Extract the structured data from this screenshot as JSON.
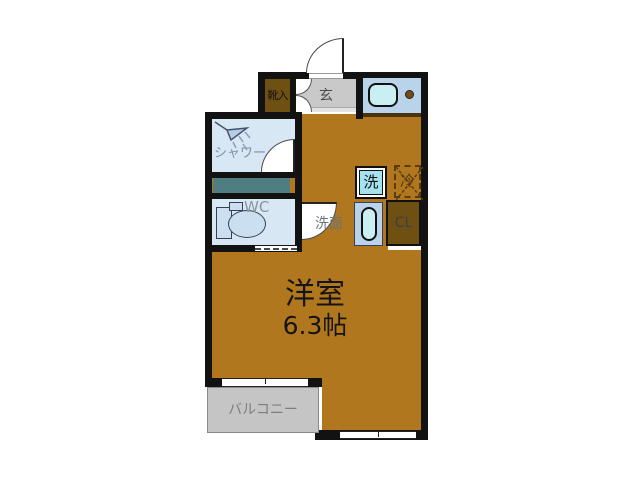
{
  "title": "apartment-floorplan",
  "rooms": {
    "main": {
      "label": "洋室",
      "size": "6.3帖"
    },
    "genkan": {
      "label": "玄"
    },
    "shoebox": {
      "label": "靴入"
    },
    "shower": {
      "label": "シャワー"
    },
    "wc": {
      "label": "WC"
    },
    "washbasin": {
      "label": "洗面"
    },
    "washer": {
      "label": "洗"
    },
    "fridge": {
      "label": "冷"
    },
    "closet": {
      "label": "CL"
    },
    "balcony": {
      "label": "バルコニー"
    }
  },
  "colors": {
    "floor": "#b0771e",
    "wall": "#121212",
    "dark_wood": "#6e5013",
    "genkan_gray": "#c9c9c9",
    "balcony_gray": "#c5c5c5",
    "counter_blue": "#b9d3ea",
    "room_blue": "#d8e7f4",
    "fixture_cyan": "#c9eff3",
    "washer_cyan": "#a5e2ef",
    "teal_strip": "#4e7e81",
    "fridge_dash": "#5a3d0e"
  }
}
